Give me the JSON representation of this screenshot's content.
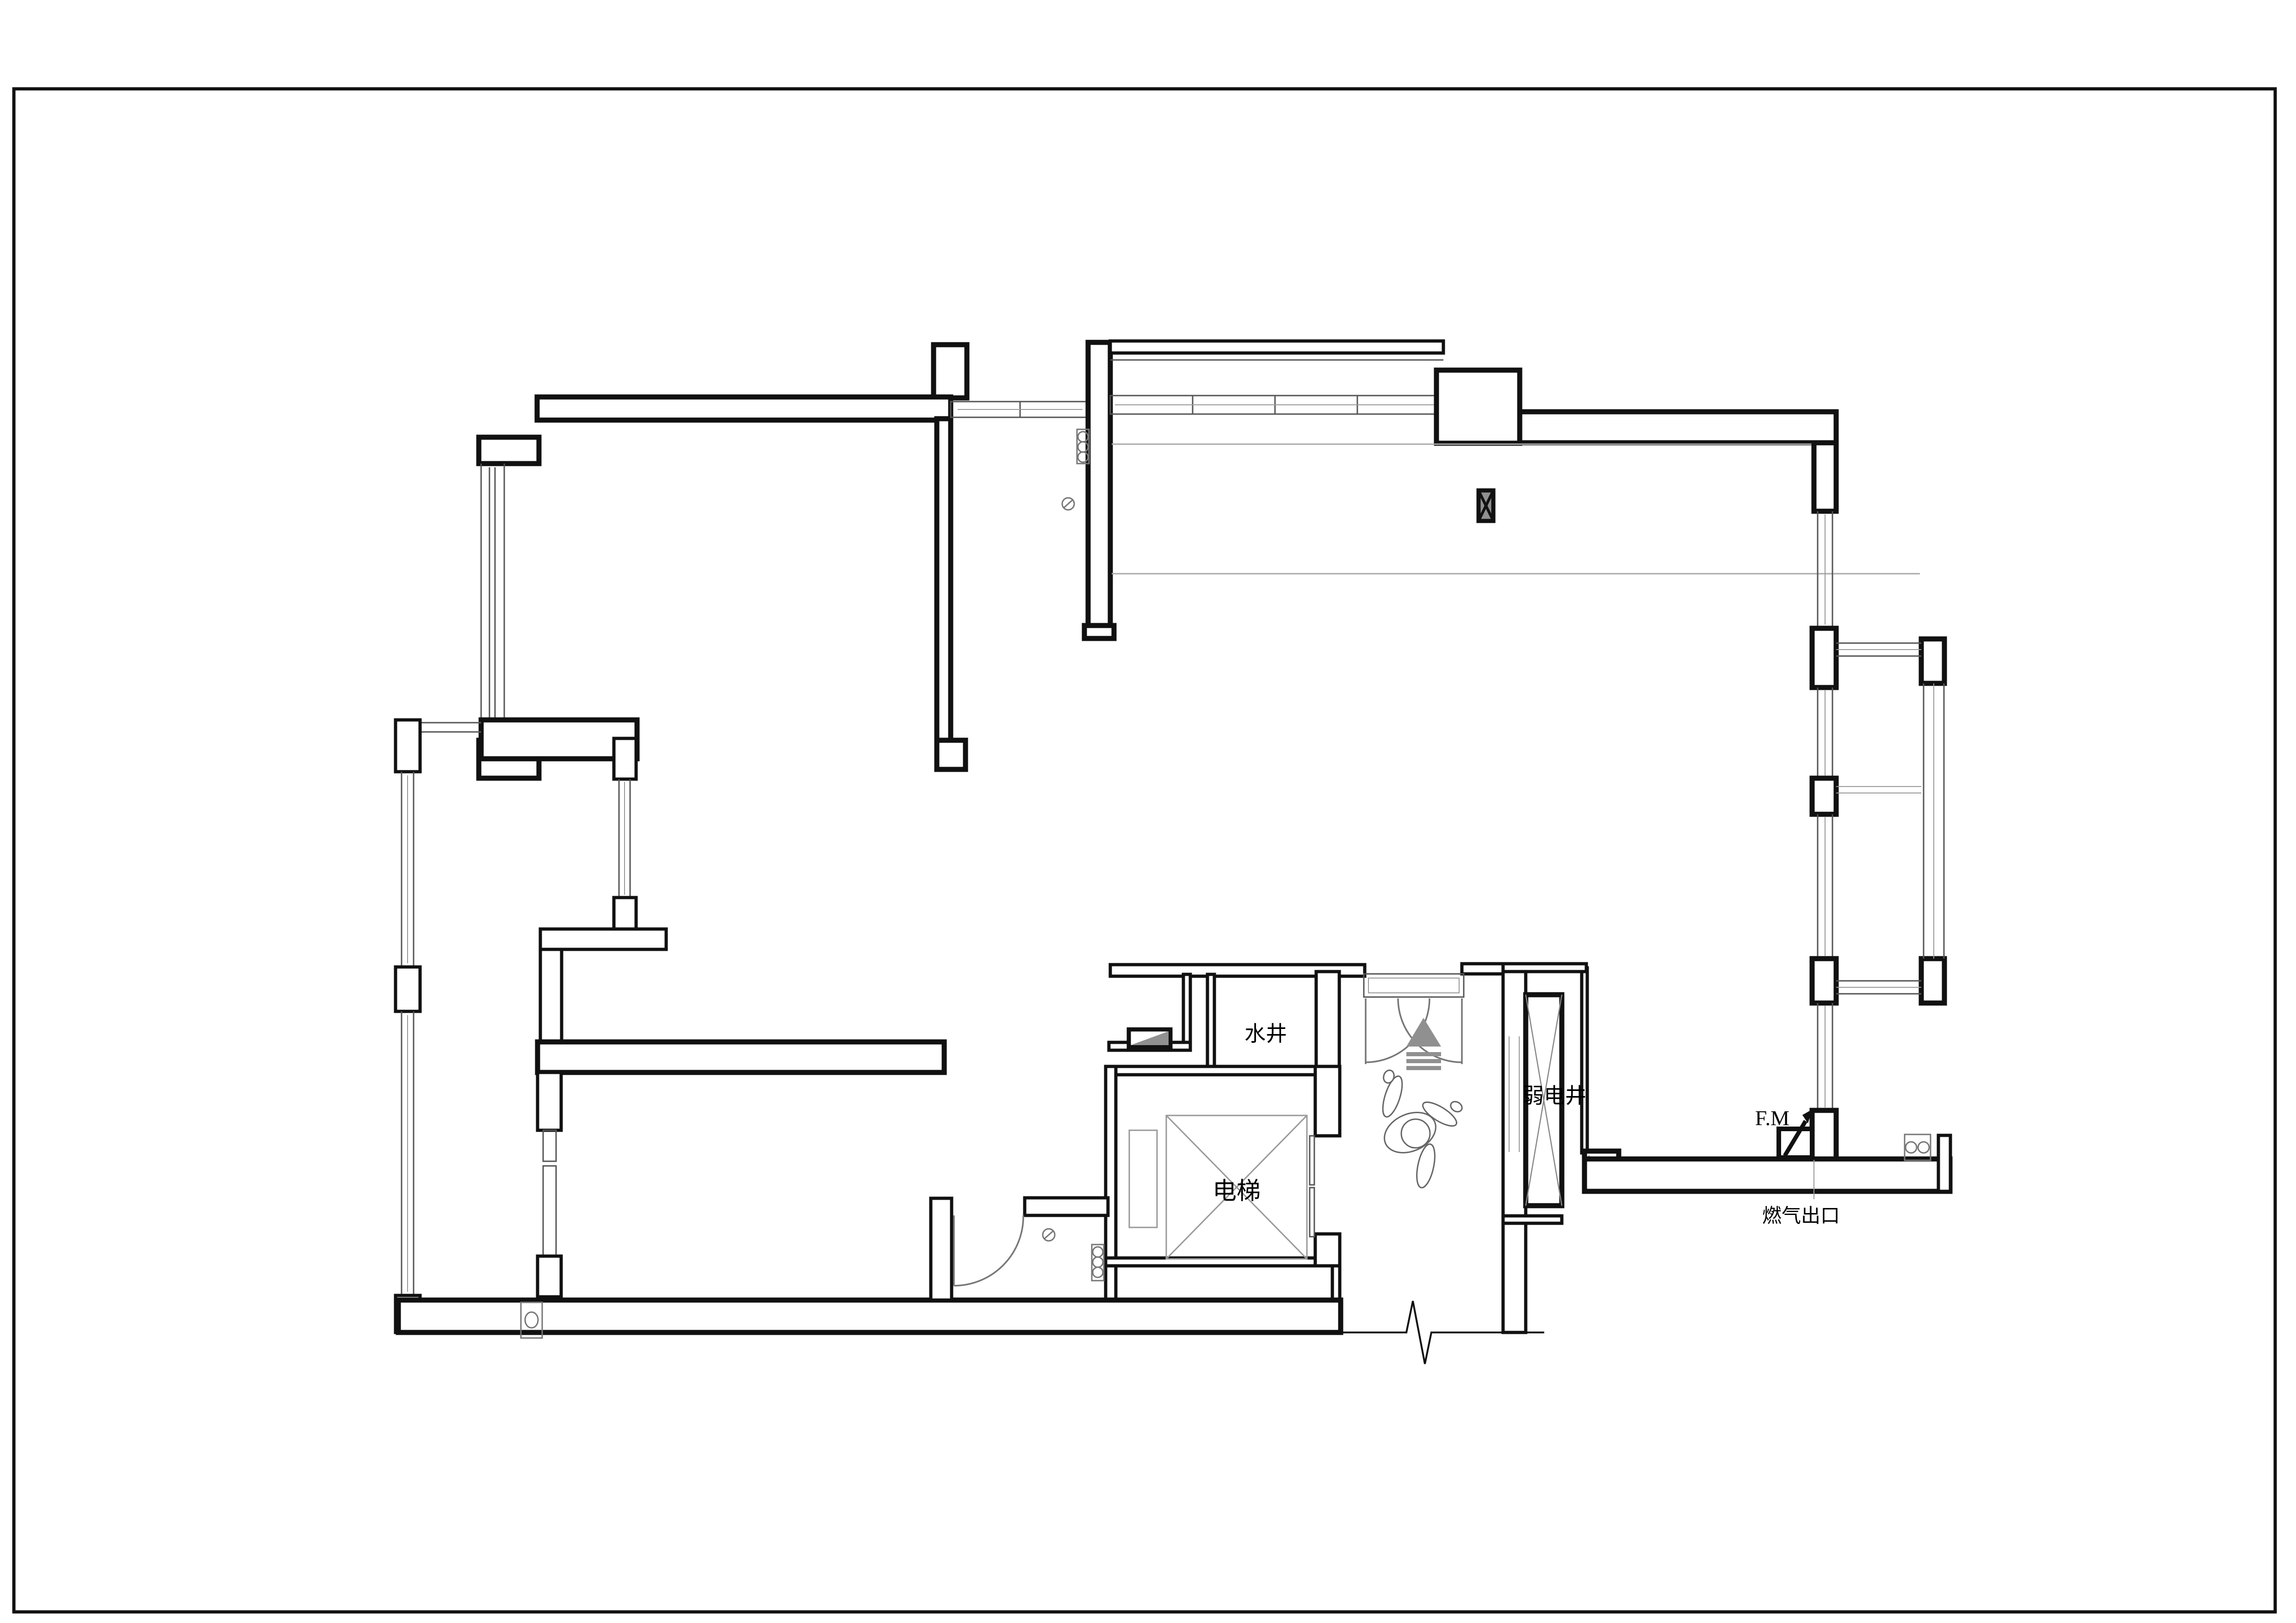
{
  "drawing": {
    "labels": {
      "water_shaft": "水井",
      "elevator": "电梯",
      "lv_shaft": "弱电井",
      "gas_meter": "F.M",
      "gas_outlet": "燃气出口"
    },
    "colors": {
      "wall": "#111111",
      "window_line": "#555555",
      "light_line": "#aaaaaa",
      "symbol_gray": "#909090",
      "background": "#ffffff"
    },
    "symbols": {
      "elevator_car": "crossed-box",
      "shaft_lv": "crossed-box",
      "column_marker": "filled-crossed-box",
      "entry_arrow": "triangle-with-steps",
      "break_line": "zigzag",
      "person": "top-view-figure"
    }
  }
}
